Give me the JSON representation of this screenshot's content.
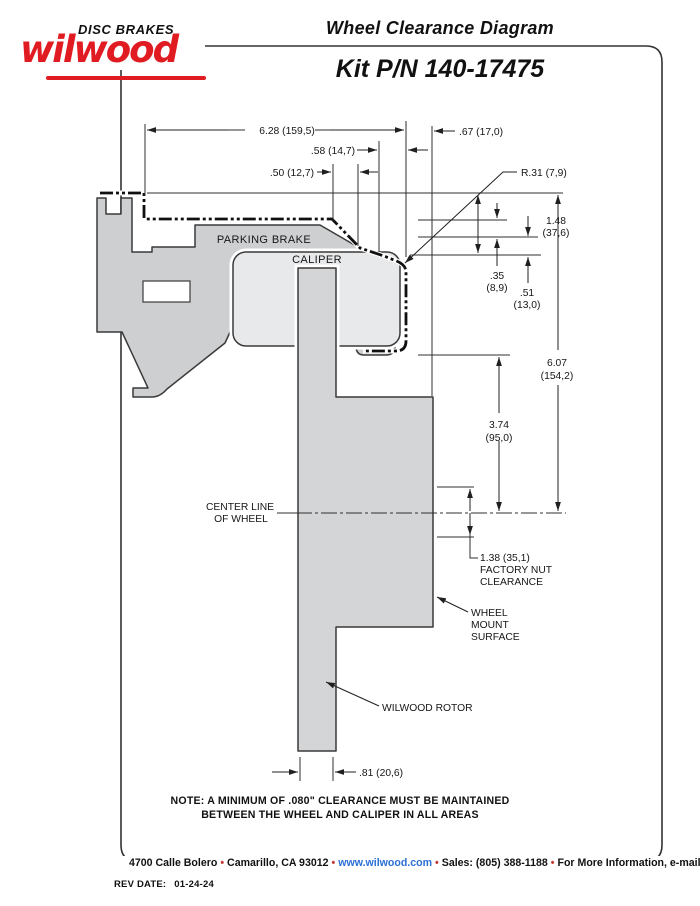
{
  "header": {
    "brand": "wilwood",
    "tagline": "DISC BRAKES",
    "title": "Wheel Clearance Diagram",
    "kit": "Kit P/N 140-17475"
  },
  "labels": {
    "parking_brake": "PARKING BRAKE",
    "caliper": "CALIPER",
    "centerline_l1": "CENTER LINE",
    "centerline_l2": "OF WHEEL",
    "nut_l1": "1.38 (35,1)",
    "nut_l2": "FACTORY NUT",
    "nut_l3": "CLEARANCE",
    "mount_l1": "WHEEL",
    "mount_l2": "MOUNT",
    "mount_l3": "SURFACE",
    "rotor": "WILWOOD ROTOR"
  },
  "dims": {
    "total_width": "6.28 (159,5)",
    "lip_width": ".67 (17,0)",
    "step_58": ".58 (14,7)",
    "step_50": ".50 (12,7)",
    "radius": "R.31 (7,9)",
    "h148_in": "1.48",
    "h148_mm": "(37,6)",
    "h35_in": ".35",
    "h35_mm": "(8,9)",
    "h51_in": ".51",
    "h51_mm": "(13,0)",
    "h607_in": "6.07",
    "h607_mm": "(154,2)",
    "h374_in": "3.74",
    "h374_mm": "(95,0)",
    "rotor_w": ".81 (20,6)"
  },
  "note": {
    "line1": "NOTE: A MINIMUM OF .080\" CLEARANCE MUST BE MAINTAINED",
    "line2": "BETWEEN THE WHEEL AND CALIPER IN ALL AREAS"
  },
  "footer": {
    "address": "4700 Calle Bolero",
    "city": "Camarillo, CA 93012",
    "website": "www.wilwood.com",
    "sales": "Sales: (805) 388-1188",
    "more_info": "For More Information, e-mail:",
    "email": "info@wilwood.com",
    "bullet": "•",
    "rev_label": "REV DATE:",
    "rev_value": "01-24-24"
  },
  "colors": {
    "brand_red": "#e11b22",
    "link_blue": "#2a6fd6",
    "knuckle_gray": "#cdcfd0",
    "rotor_gray": "#d4d5d6",
    "caliper_gray": "#e8e9ea",
    "line": "#2f2f2f"
  }
}
